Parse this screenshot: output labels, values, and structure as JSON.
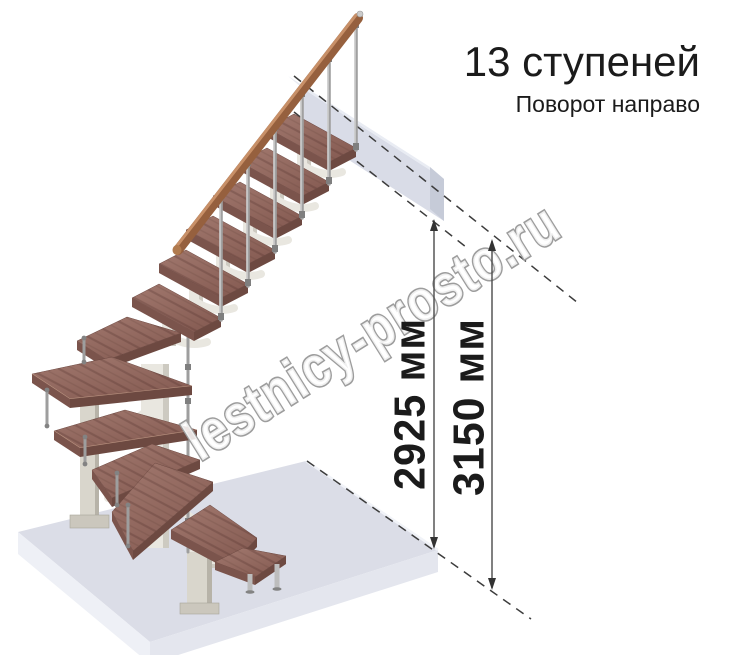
{
  "header": {
    "steps_count_label": "13 ступеней",
    "turn_label": "Поворот направо"
  },
  "dimension_labels": {
    "landing_height": "2925 мм",
    "total_height": "3150 мм"
  },
  "watermark": {
    "text": "lestnicy-prosto.ru"
  },
  "colors": {
    "tread_brown": "#8a6057",
    "handrail_brown": "#96603e",
    "floor_gray": "#dbdde7",
    "landing_gray": "#d6dae6",
    "structure_ivory": "#e9e7e0",
    "column_beige": "#d9d6cc",
    "dimension_line": "#3c3c3c",
    "watermark_outline": "#9d9d9d",
    "text": "#1b1b1b"
  }
}
